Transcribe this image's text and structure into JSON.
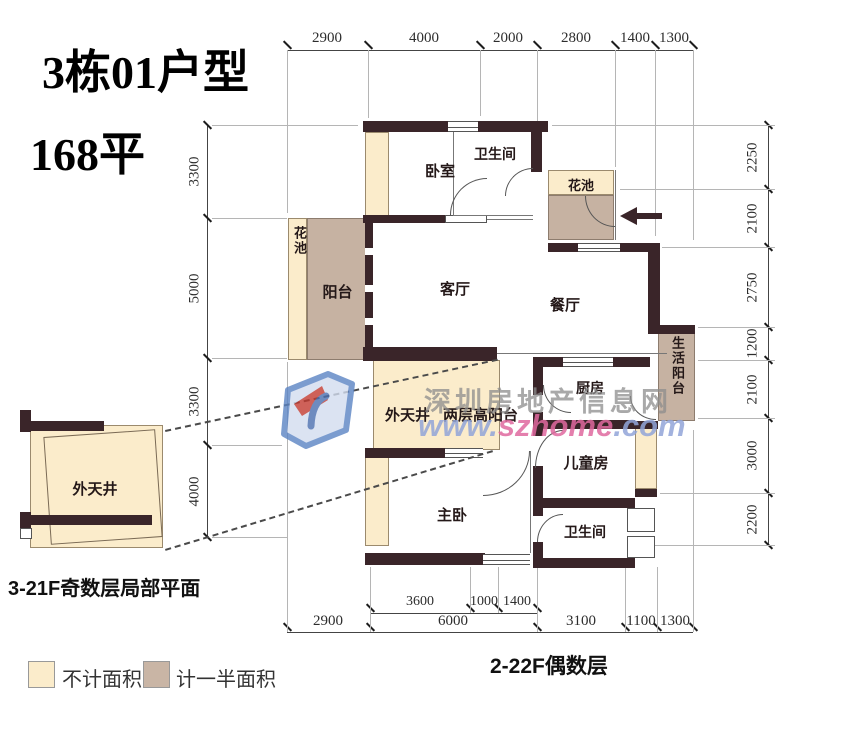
{
  "title": {
    "line1": "3栋01户型",
    "line2": "168平"
  },
  "captions": {
    "detail": "3-21F奇数层局部平面",
    "floors": "2-22F偶数层"
  },
  "legend": {
    "no_area": "不计面积",
    "half_area": "计一半面积"
  },
  "watermark": {
    "name": "深圳房地产信息网",
    "www": "www.",
    "domain": "szhome",
    "tld": ".com"
  },
  "rooms": {
    "bedroom": "卧室",
    "bath_top": "卫生间",
    "flower_top": "花池",
    "flower_left": "花池",
    "balcony": "阳台",
    "living": "客厅",
    "dining": "餐厅",
    "life_balcony": "生活阳台",
    "kitchen": "厨房",
    "courtyard": "外天井",
    "high_balcony": "两层高阳台",
    "kids": "儿童房",
    "master": "主卧",
    "bath_bottom": "卫生间",
    "courtyard_detail": "外天井"
  },
  "dims": {
    "top": [
      "2900",
      "4000",
      "2000",
      "2800",
      "1400",
      "1300"
    ],
    "right": [
      "2250",
      "2100",
      "2750",
      "1200",
      "2100",
      "3000",
      "2200"
    ],
    "left": [
      "3300",
      "5000",
      "3300",
      "4000"
    ],
    "bottom_main": [
      "2900",
      "6000",
      "3100",
      "1100",
      "1300"
    ],
    "bottom_sub": [
      "3600",
      "1000",
      "1400"
    ]
  },
  "colors": {
    "wall": "#3a2529",
    "no_area": "#fbeccb",
    "half_area": "#c6b2a2"
  }
}
